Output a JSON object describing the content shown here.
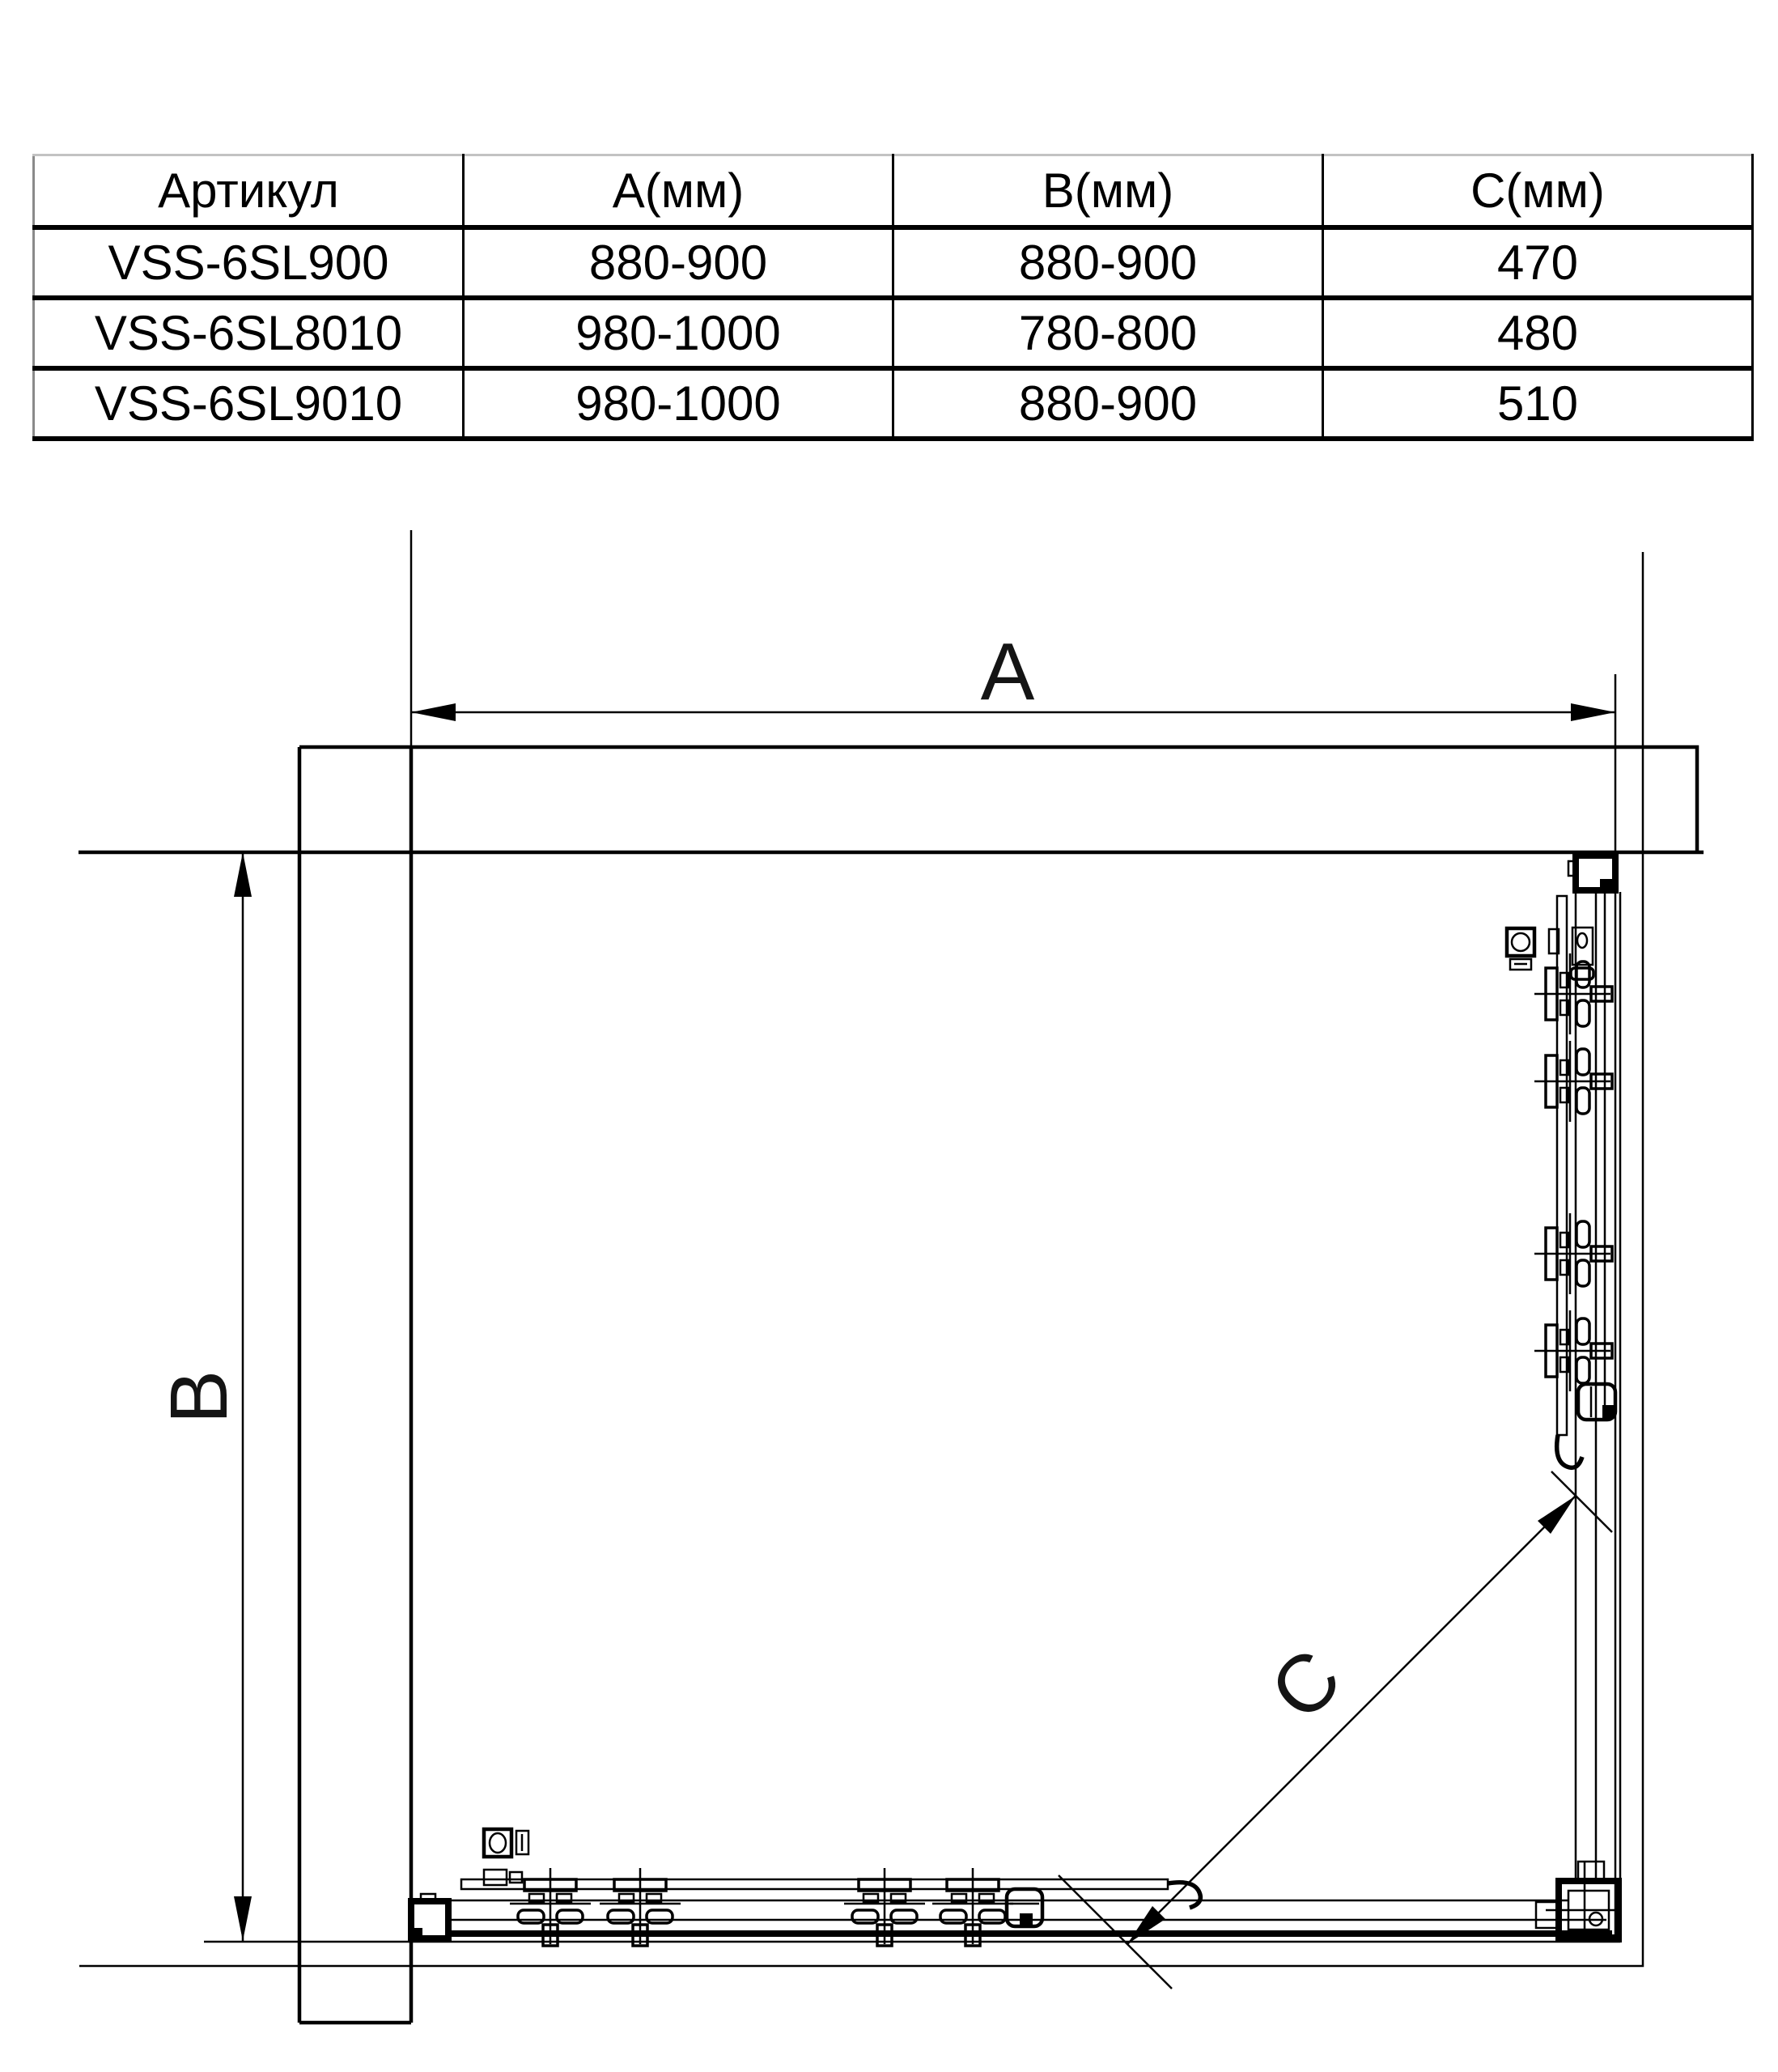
{
  "table": {
    "columns": [
      "Артикул",
      "A(мм)",
      "B(мм)",
      "C(мм)"
    ],
    "rows": [
      [
        "VSS-6SL900",
        "880-900",
        "880-900",
        "470"
      ],
      [
        "VSS-6SL8010",
        "980-1000",
        "780-800",
        "480"
      ],
      [
        "VSS-6SL9010",
        "980-1000",
        "880-900",
        "510"
      ]
    ]
  },
  "diagram": {
    "dim_labels": {
      "a": "A",
      "b": "B",
      "c": "C"
    },
    "stroke_color": "#000000"
  }
}
